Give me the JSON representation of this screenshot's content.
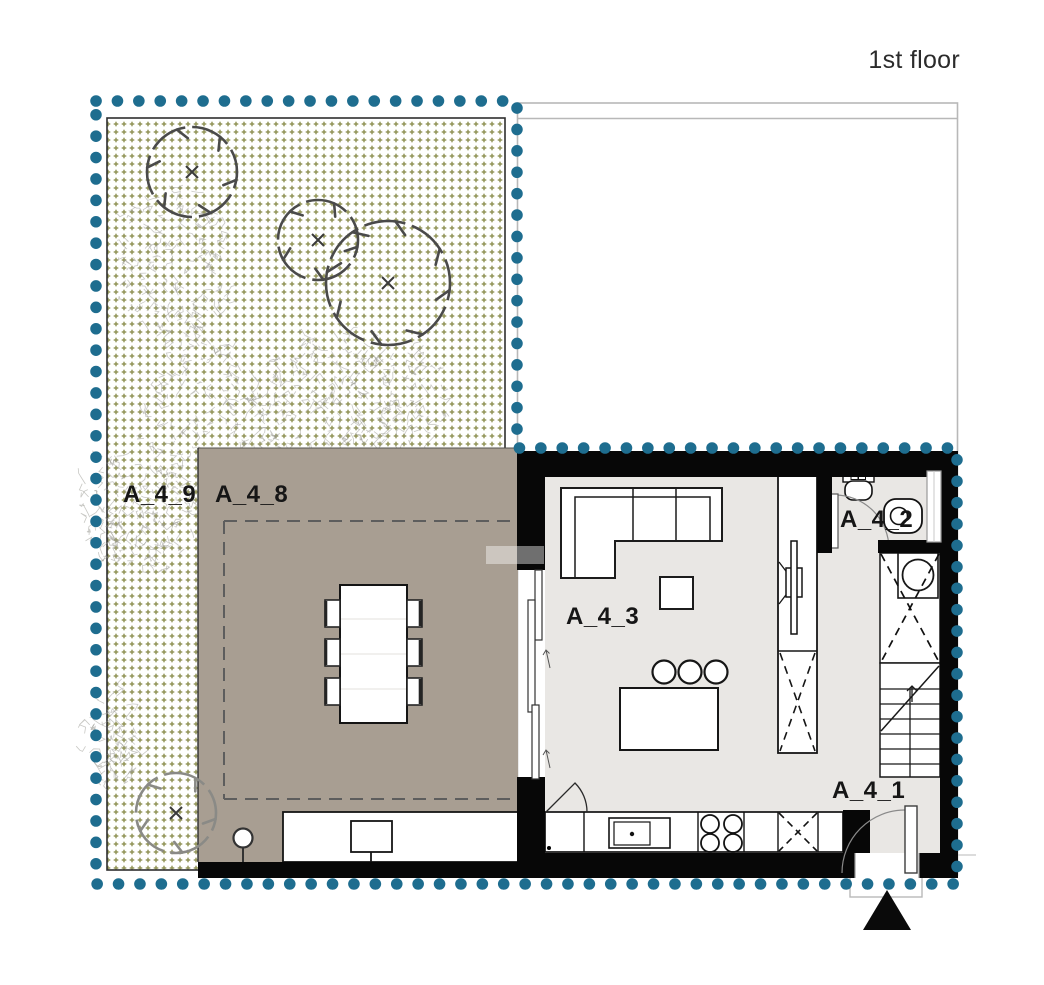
{
  "plan": {
    "title": "1st floor",
    "rooms": {
      "garden": {
        "label": "A_4_9"
      },
      "terrace": {
        "label": "A_4_8"
      },
      "living": {
        "label": "A_4_3"
      },
      "wc": {
        "label": "A_4_2"
      },
      "entry": {
        "label": "A_4_1"
      }
    },
    "colors": {
      "boundary_dots": "#1e6d8f",
      "terrace_fill": "#a89e92",
      "interior_floor": "#e9e7e4",
      "walls": "#070707",
      "garden_pattern": "#8e9052",
      "outline_gray": "#b8b8b8"
    }
  }
}
